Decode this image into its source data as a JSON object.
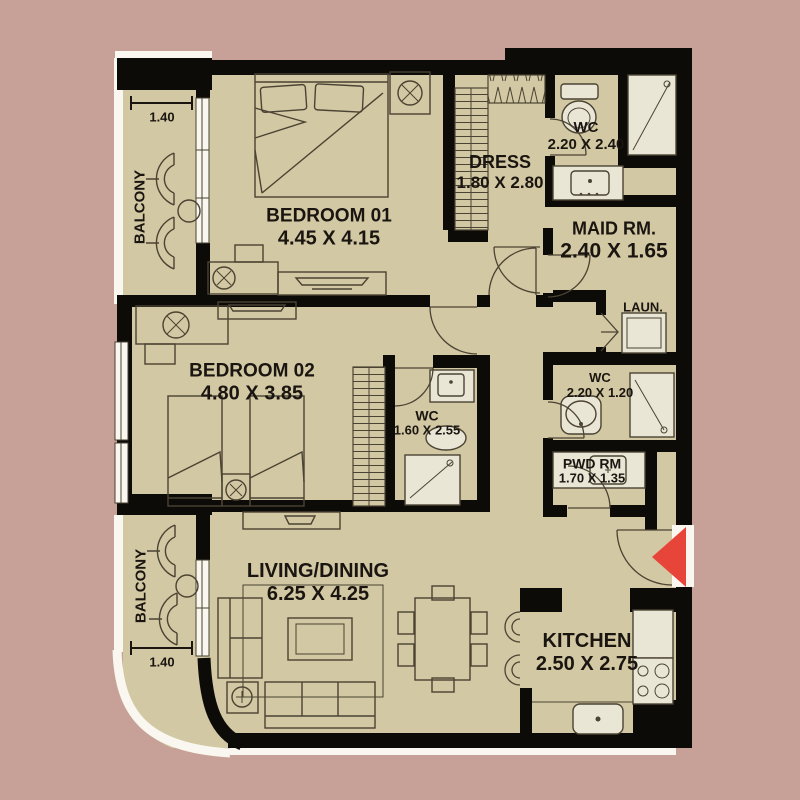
{
  "colors": {
    "background": "#c7a197",
    "floor": "#d2c8a3",
    "wall": "#0d0b08",
    "line": "#4b4333",
    "fixture": "#eae6d6",
    "window": "#f9f7ef",
    "accent_red": "#e8453a",
    "text": "#1a1510"
  },
  "rooms": {
    "bedroom01": {
      "label": "BEDROOM 01",
      "dims": "4.45 X 4.15"
    },
    "bedroom02": {
      "label": "BEDROOM 02",
      "dims": "4.80 X 3.85"
    },
    "dress": {
      "label": "DRESS",
      "dims": "1.80 X 2.80"
    },
    "wc_master": {
      "label": "WC",
      "dims": "2.20 X 2.40"
    },
    "maid_room": {
      "label": "MAID RM.",
      "dims": "2.40 X 1.65"
    },
    "laundry": {
      "label": "LAUN."
    },
    "wc_guest": {
      "label": "WC",
      "dims": "2.20 X 1.20"
    },
    "powder_room": {
      "label": "PWD RM",
      "dims": "1.70 X 1.35"
    },
    "wc_bedroom02": {
      "label": "WC",
      "dims": "1.60 X 2.55"
    },
    "living_dining": {
      "label": "LIVING/DINING",
      "dims": "6.25 X 4.25"
    },
    "kitchen": {
      "label": "KITCHEN",
      "dims": "2.50 X 2.75"
    },
    "balcony_top": {
      "label": "BALCONY",
      "width_dim": "1.40"
    },
    "balcony_bottom": {
      "label": "BALCONY",
      "width_dim": "1.40"
    }
  }
}
